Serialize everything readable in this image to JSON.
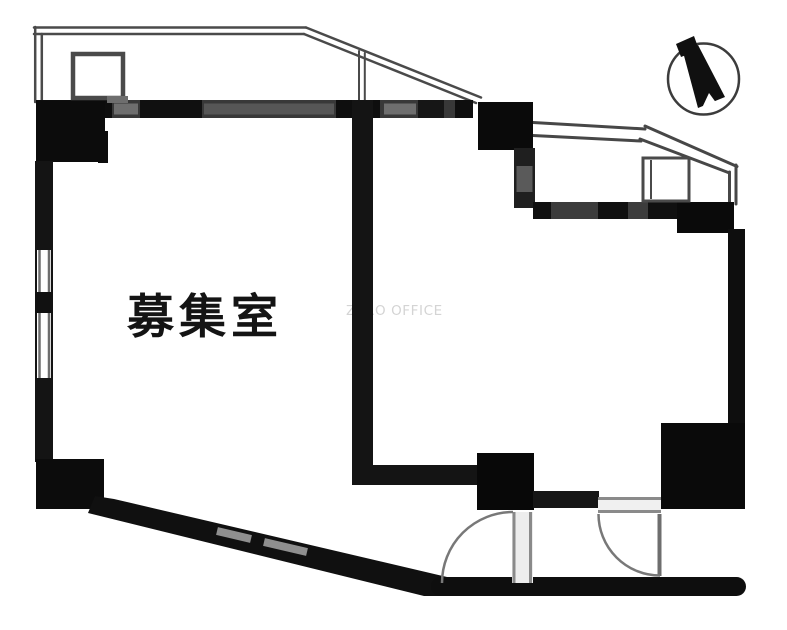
{
  "floorplan": {
    "room_label": "募集室",
    "watermark": "ZERO OFFICE",
    "compass_icon": "north-arrow-compass",
    "colors": {
      "wall": "#141414",
      "outline_line": "#4a4a4a",
      "window_line": "#8f8f8f",
      "door_arc": "#787878",
      "label_text": "#141414",
      "watermark_text": "#d4d4d4",
      "background": "#ffffff"
    }
  }
}
